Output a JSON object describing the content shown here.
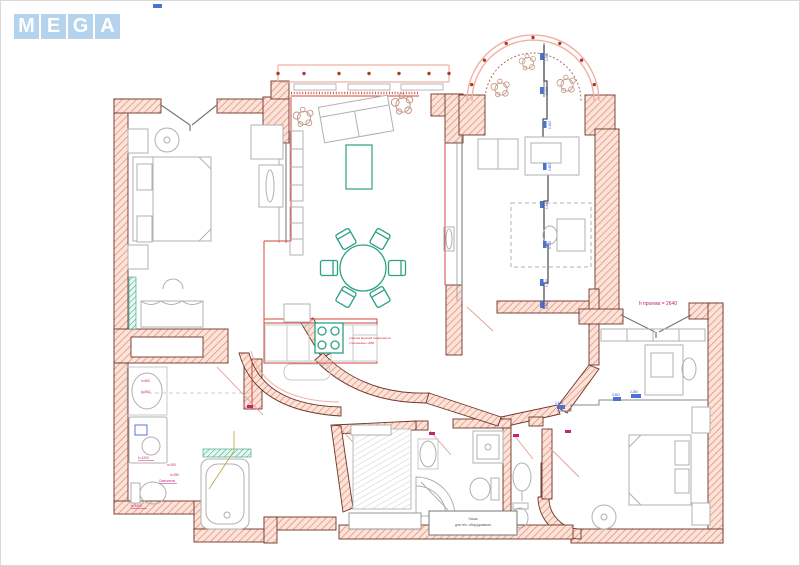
{
  "logo": {
    "letters": [
      "M",
      "E",
      "G",
      "A"
    ],
    "tile_color": "#b5d3ec",
    "letter_color": "#ffffff"
  },
  "annotations": {
    "doorway_height": "h проема = 2640",
    "niche_line1": "Ниша",
    "niche_line2": "для тех. оборудования",
    "kitchen_note_line1": "отметка верхней поверхности",
    "kitchen_note_line2": "столешницы +850",
    "sink_height_1": "h=500",
    "sink_height_2": "h=900",
    "washer_height": "h=1200",
    "tub_height_1": "h=200",
    "tub_height_2": "h=250",
    "mixer_label": "Смеситель",
    "toilet_height": "h=1000"
  },
  "dimensions": {
    "partition": [
      "1.500",
      "0.900",
      "1.200",
      "0.600",
      "1.480",
      "0.700",
      "1.100",
      "0.800"
    ],
    "bedroom2": [
      "0.600",
      "2.280"
    ],
    "hallway": "1.440"
  },
  "colors": {
    "wall_fill": "#fbe3da",
    "wall_hatch": "#e08a70",
    "wall_outline": "#6e3327",
    "furniture_gray": "#b0b0b0",
    "accent_red": "#d4453a",
    "accent_pink": "#f2b0a2",
    "accent_green": "#2ea183",
    "dimension_blue": "#3355cc",
    "label_magenta": "#c2247a"
  }
}
